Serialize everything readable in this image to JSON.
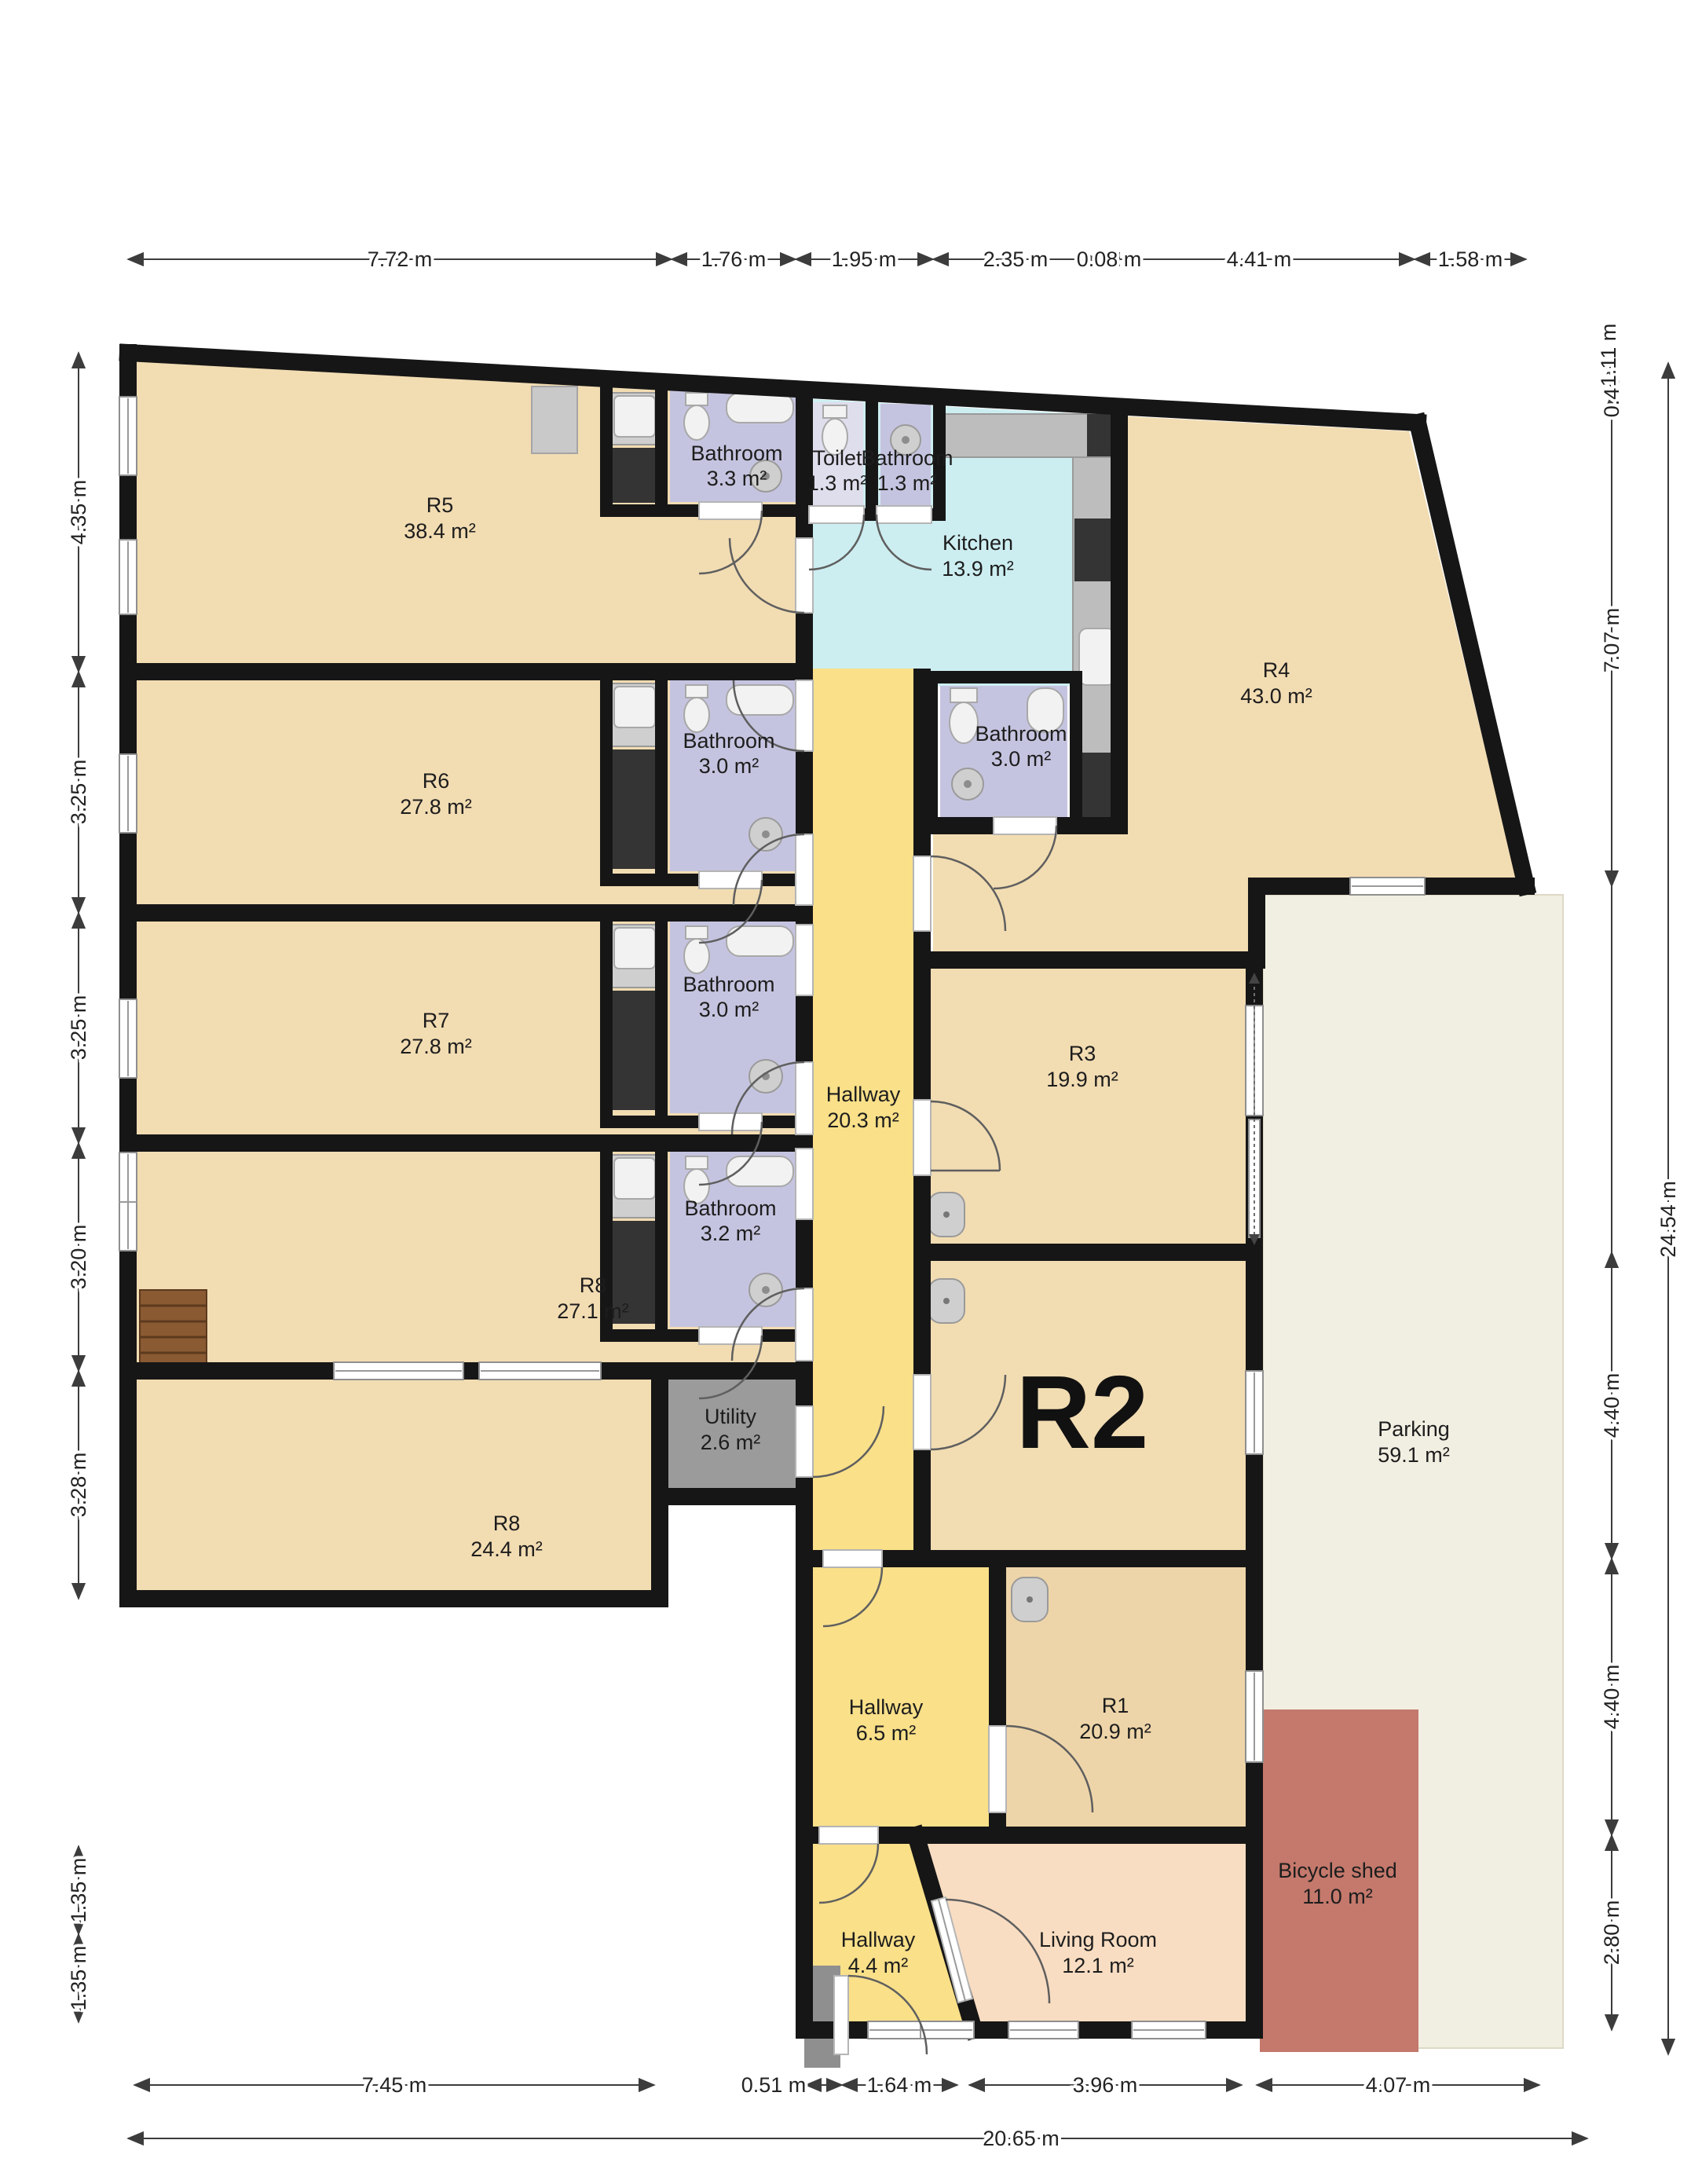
{
  "plan_type": "floor-plan",
  "colors": {
    "wall": "#161616",
    "room_tan": "#f2dcb2",
    "kitchen_cyan": "#cdeef1",
    "hallway_yellow": "#f9e089",
    "bathroom_lavender": "#c5c4e0",
    "toilet_lavender": "#dfdeed",
    "parking_cream": "#f1efe2",
    "bicycle_shed_red": "#c4796c",
    "living_room_peach": "#f9ddc2",
    "utility_gray": "#9b9b9b",
    "stairs_brown": "#8a5a33"
  },
  "rooms": {
    "r5": {
      "name": "R5",
      "area": "38.4 m²"
    },
    "bathroom_r5": {
      "name": "Bathroom",
      "area": "3.3 m²"
    },
    "toilet": {
      "name": "Toilet",
      "area": "1.3 m²"
    },
    "bathroom_small": {
      "name": "Bathroom",
      "area": "1.3 m²"
    },
    "kitchen": {
      "name": "Kitchen",
      "area": "13.9 m²"
    },
    "r4": {
      "name": "R4",
      "area": "43.0 m²"
    },
    "r6": {
      "name": "R6",
      "area": "27.8 m²"
    },
    "bathroom_r6": {
      "name": "Bathroom",
      "area": "3.0 m²"
    },
    "bathroom_r4": {
      "name": "Bathroom",
      "area": "3.0 m²"
    },
    "r7": {
      "name": "R7",
      "area": "27.8 m²"
    },
    "bathroom_r7": {
      "name": "Bathroom",
      "area": "3.0 m²"
    },
    "r3": {
      "name": "R3",
      "area": "19.9 m²"
    },
    "hallway_main": {
      "name": "Hallway",
      "area": "20.3 m²"
    },
    "r8a": {
      "name": "R8",
      "area": "27.1 m²"
    },
    "bathroom_r8": {
      "name": "Bathroom",
      "area": "3.2 m²"
    },
    "r2": {
      "name": "R2"
    },
    "parking": {
      "name": "Parking",
      "area": "59.1 m²"
    },
    "r8b": {
      "name": "R8",
      "area": "24.4 m²"
    },
    "utility": {
      "name": "Utility",
      "area": "2.6 m²"
    },
    "hallway_mid": {
      "name": "Hallway",
      "area": "6.5 m²"
    },
    "r1": {
      "name": "R1",
      "area": "20.9 m²"
    },
    "hallway_entry": {
      "name": "Hallway",
      "area": "4.4 m²"
    },
    "living_room": {
      "name": "Living Room",
      "area": "12.1 m²"
    },
    "bicycle_shed": {
      "name": "Bicycle shed",
      "area": "11.0 m²"
    }
  },
  "dimensions": {
    "top": [
      "7.72 m",
      "1.76 m",
      "1.95 m",
      "2.35 m",
      "0.08 m",
      "4.41 m",
      "1.58 m"
    ],
    "left": [
      "4.35 m",
      "3.25 m",
      "3.25 m",
      "3.20 m",
      "3.28 m",
      "1.35 m",
      "1.35 m"
    ],
    "right": [
      "0.46 m",
      "1.11 m",
      "7.07 m",
      "4.40 m",
      "4.40 m",
      "2.80 m"
    ],
    "right_total": "24.54 m",
    "bottom": [
      "7.45 m",
      "0.51 m",
      "1.64 m",
      "3.96 m",
      "4.07 m"
    ],
    "bottom_total": "20.65 m"
  }
}
